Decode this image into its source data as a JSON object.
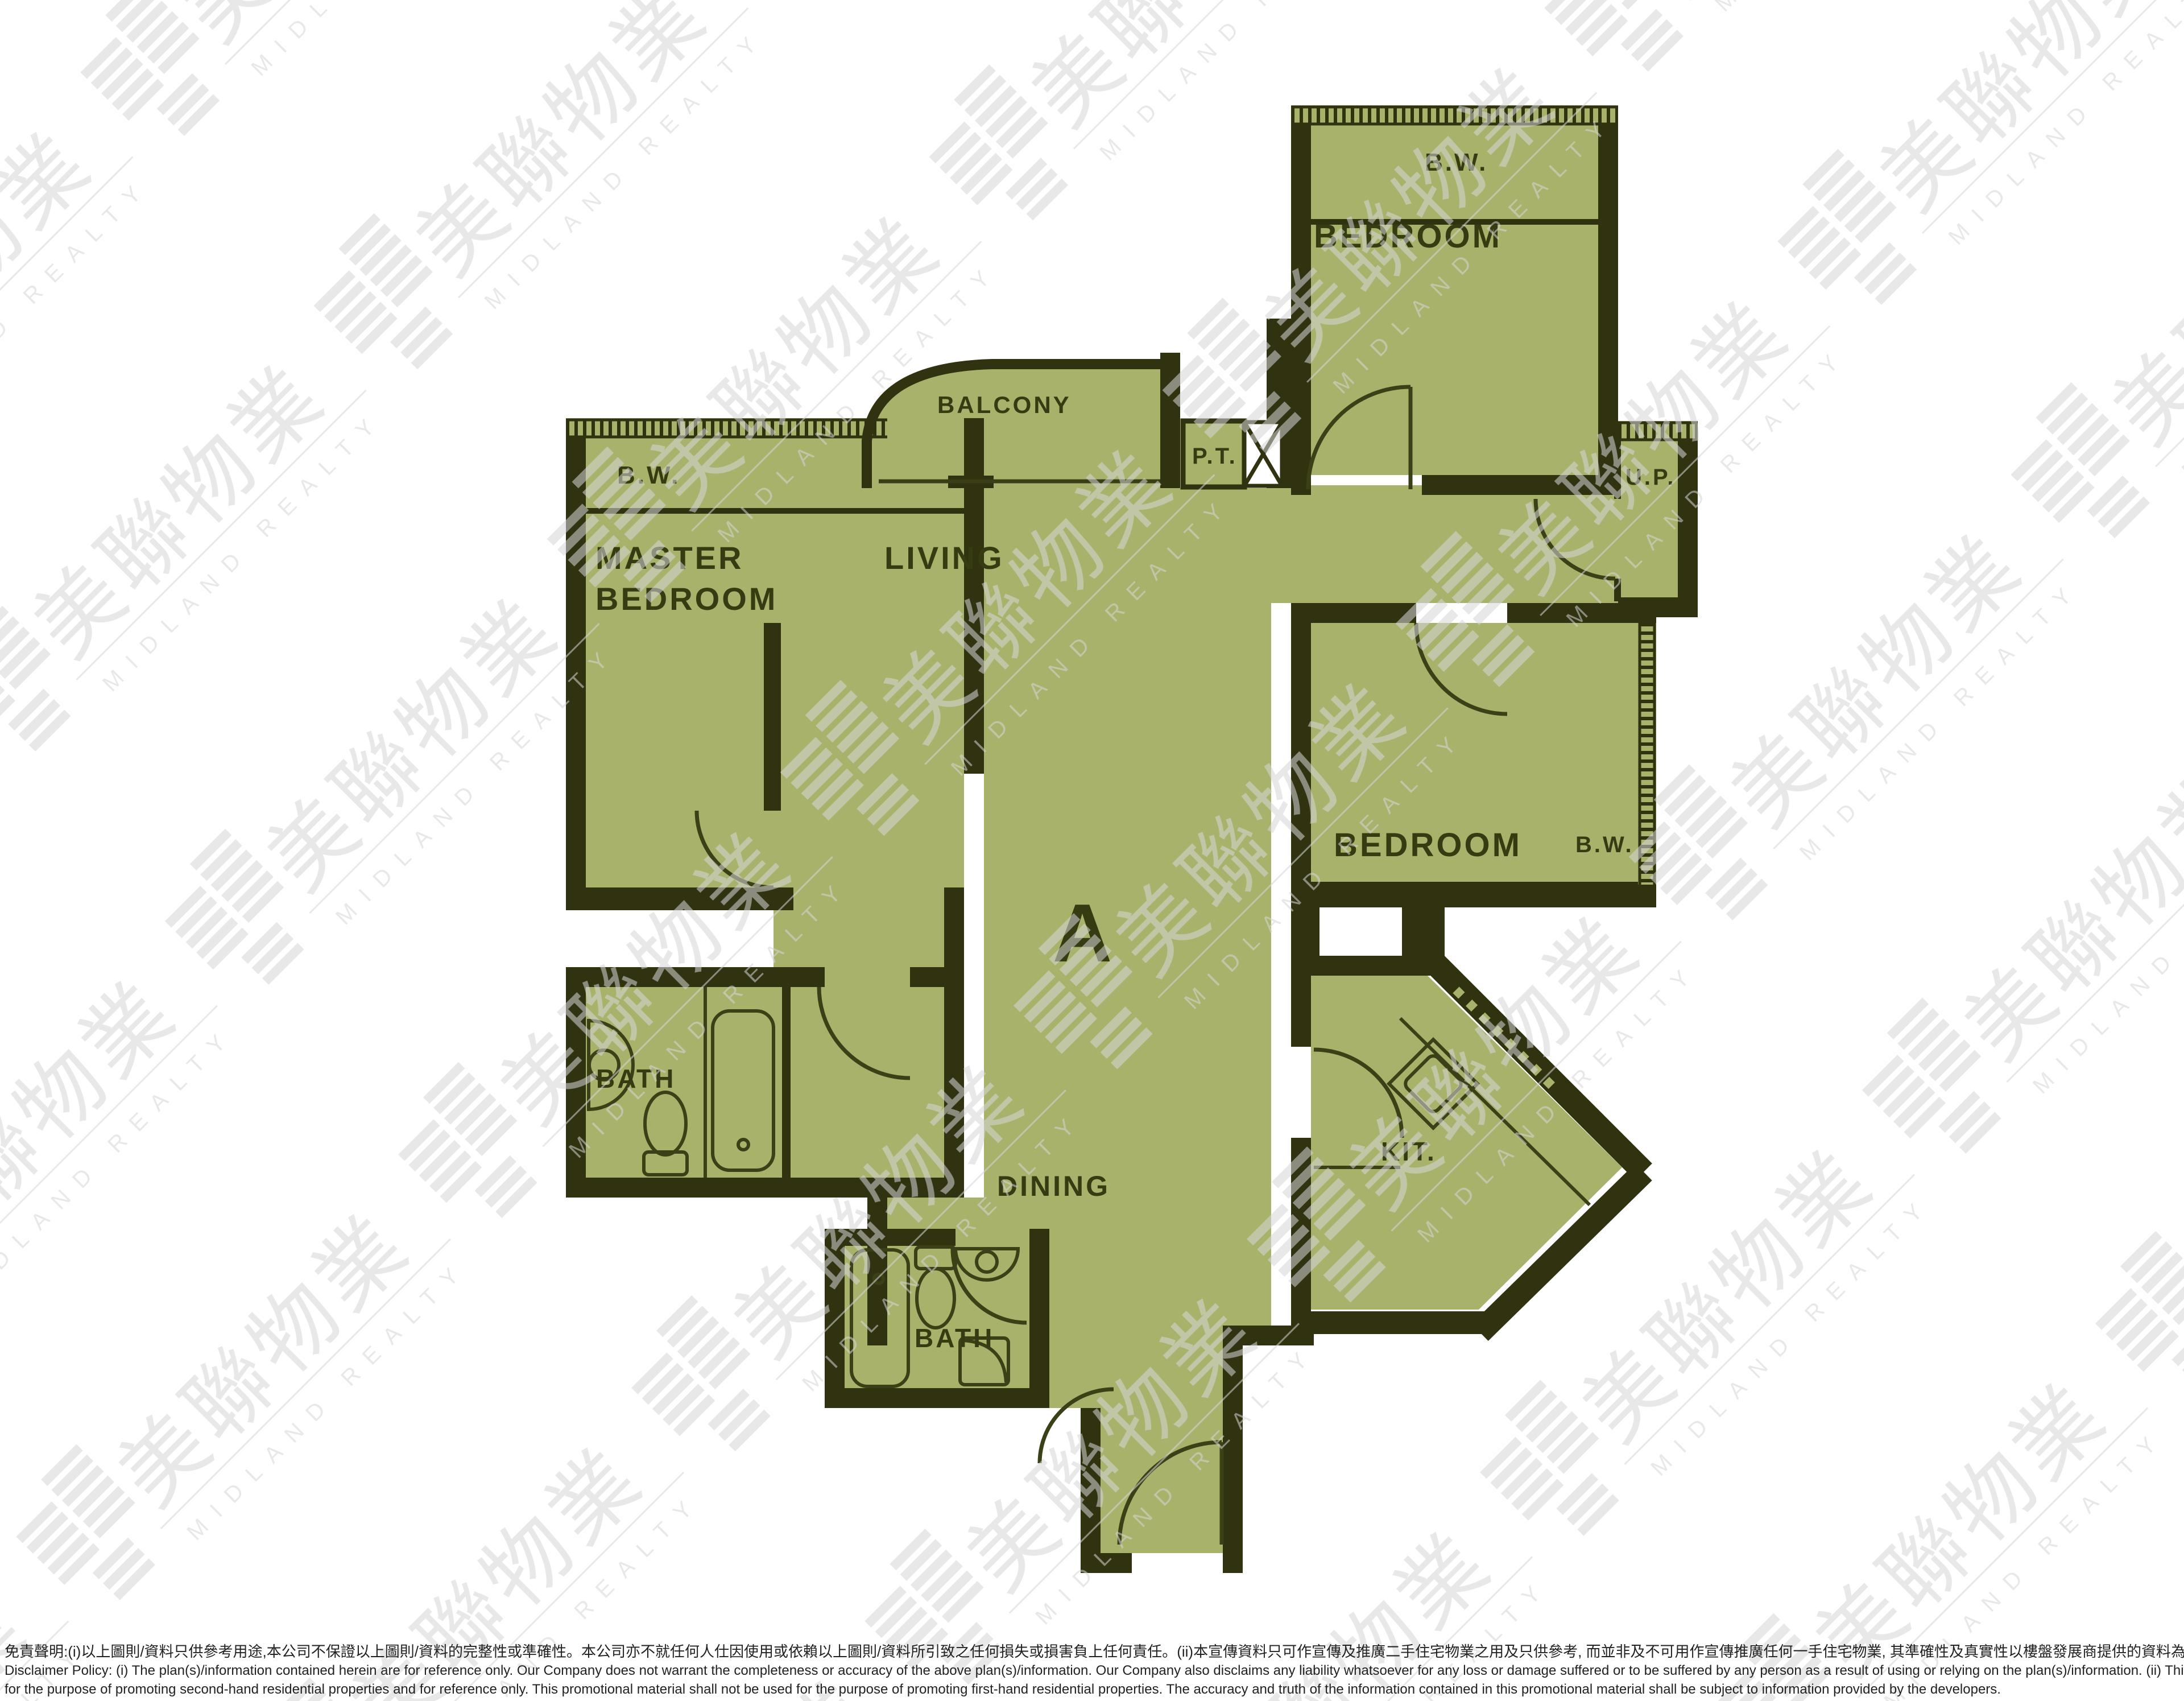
{
  "watermark": {
    "chinese": "美聯物業",
    "english": "MIDLAND REALTY"
  },
  "unit_label": "A",
  "rooms": {
    "master_bedroom": {
      "line1": "MASTER",
      "line2": "BEDROOM",
      "bw": "B.W."
    },
    "living": {
      "label": "LIVING"
    },
    "balcony": {
      "label": "BALCONY"
    },
    "pipe_trench": {
      "label": "P.T."
    },
    "utility_platform": {
      "label": "U.P."
    },
    "bedroom_top": {
      "label": "BEDROOM",
      "bw": "B.W."
    },
    "bedroom_mid": {
      "label": "BEDROOM",
      "bw": "B.W."
    },
    "bath_master": {
      "label": "BATH"
    },
    "bath_second": {
      "label": "BATH"
    },
    "dining": {
      "label": "DINING"
    },
    "kitchen": {
      "label": "KIT."
    }
  },
  "colors": {
    "floor": "#a8b26b",
    "wall": "#303210",
    "label_text": "#363b12",
    "watermark": "#d6d6d6",
    "background": "#ffffff"
  },
  "disclaimer": {
    "line1_zh": "免責聲明:(i)以上圖則/資料只供參考用途,本公司不保證以上圖則/資料的完整性或準確性。本公司亦不就任何人仕因使用或依賴以上圖則/資料所引致之任何損失或損害負上任何責任。(ii)本宣傳資料只可作宣傳及推廣二手住宅物業之用及只供參考, 而並非及不可用作宣傳推廣任何一手住宅物業, 其準確性及真實性以樓盤發展商提供的資料為準。",
    "line2_en": "Disclaimer Policy: (i) The plan(s)/information contained herein are for reference only. Our Company does not warrant the completeness or accuracy of the above plan(s)/information. Our Company also disclaims any liability whatsoever for any loss or damage suffered or to be suffered by any person as a result of using or relying on the plan(s)/information. (ii) This promotional material is",
    "line3_en": "for the purpose of promoting second-hand residential properties and for reference only. This promotional material shall not be used for the purpose of promoting first-hand residential properties. The accuracy and truth of the information contained in this promotional material shall be subject to information provided by the developers."
  }
}
